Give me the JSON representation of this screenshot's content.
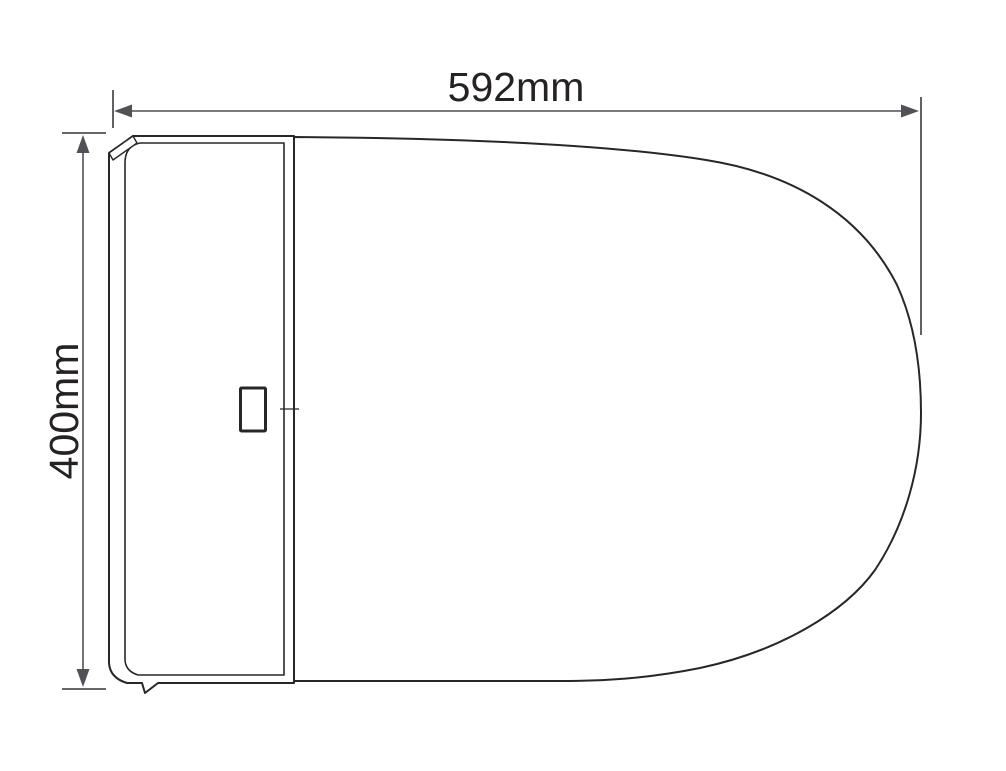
{
  "diagram": {
    "subject": "Toilet top view outline drawing",
    "dimensions": {
      "width": {
        "label": "592mm",
        "value": 592,
        "unit": "mm",
        "orientation": "horizontal"
      },
      "depth": {
        "label": "400mm",
        "value": 400,
        "unit": "mm",
        "orientation": "vertical"
      }
    },
    "colors": {
      "background": "#ffffff",
      "outline": "#2a2627",
      "dimension": "#515156",
      "label_text": "#262223"
    }
  }
}
